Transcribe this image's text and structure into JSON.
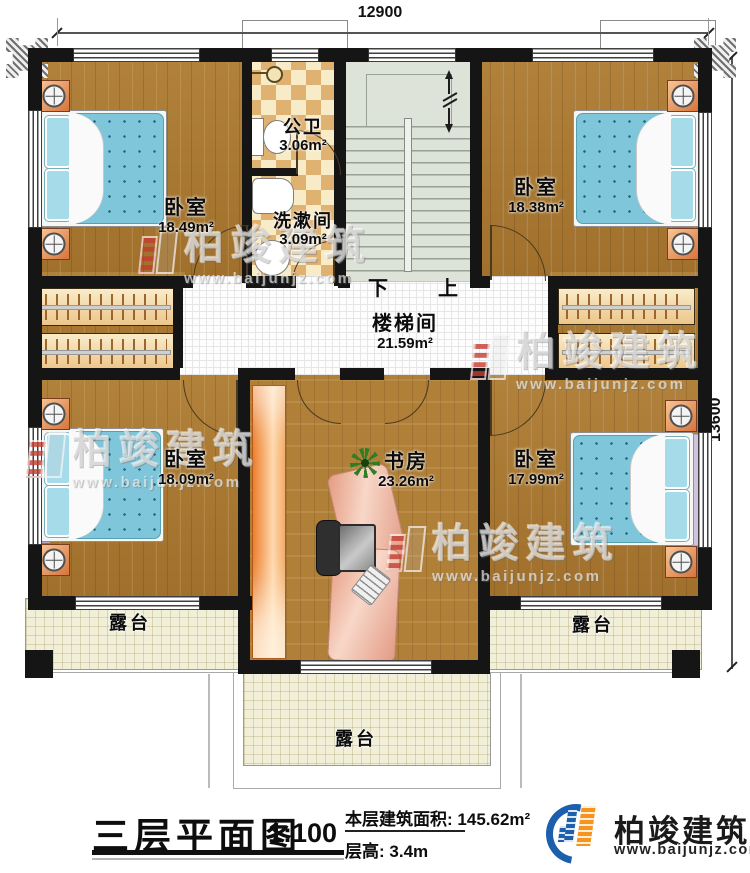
{
  "plan": {
    "dimensions": {
      "top": "12900",
      "right": "13600"
    },
    "rooms": {
      "bedroom_tl": {
        "name": "卧室",
        "area": "18.49m²"
      },
      "bedroom_tr": {
        "name": "卧室",
        "area": "18.38m²"
      },
      "bedroom_bl": {
        "name": "卧室",
        "area": "18.09m²"
      },
      "bedroom_br": {
        "name": "卧室",
        "area": "17.99m²"
      },
      "bathroom": {
        "name": "公卫",
        "area": "3.06m²"
      },
      "washroom": {
        "name": "洗漱间",
        "area": "3.09m²"
      },
      "stair_hall": {
        "name": "楼梯间",
        "area": "21.59m²"
      },
      "study": {
        "name": "书房",
        "area": "23.26m²"
      },
      "terrace_left": {
        "name": "露台"
      },
      "terrace_right": {
        "name": "露台"
      },
      "terrace_bottom": {
        "name": "露台"
      }
    },
    "stairs": {
      "down": "下",
      "up": "上"
    }
  },
  "titleblock": {
    "title": "三层平面图",
    "scale": "1:100",
    "area_label": "本层建筑面积:",
    "area_value": "145.62m²",
    "floor_height_label": "层高:",
    "floor_height_value": "3.4m"
  },
  "brand": {
    "name": "柏竣建筑",
    "url": "www.baijunjz.com"
  },
  "watermark": {
    "name": "柏竣建筑",
    "url": "www.baijunjz.com"
  },
  "colors": {
    "wall": "#151515",
    "wood_floor": "#a97830",
    "bathroom_tile": "#e0b271",
    "stair_floor": "#dde3d8",
    "terrace_floor": "#f2efd9",
    "bed_mattress": "#7fc6da",
    "cabinet_orange": "#ec7b28",
    "logo_blue": "#1c5fad",
    "logo_orange": "#f7941d"
  }
}
